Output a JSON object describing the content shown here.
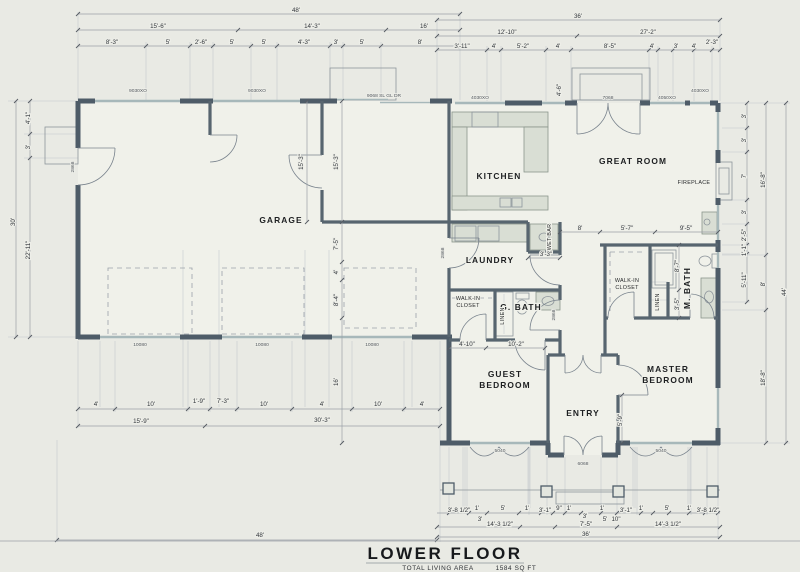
{
  "drawing": {
    "sheet_title": "LOWER FLOOR",
    "area_label": "TOTAL LIVING AREA",
    "area_value": "1584 SQ FT"
  },
  "room_labels": [
    {
      "t": "GARAGE",
      "x": 281,
      "y": 223
    },
    {
      "t": "KITCHEN",
      "x": 499,
      "y": 179
    },
    {
      "t": "GREAT ROOM",
      "x": 633,
      "y": 164
    },
    {
      "t": "LAUNDRY",
      "x": 490,
      "y": 263
    },
    {
      "t": "G. BATH",
      "x": 521,
      "y": 310
    },
    {
      "t": "GUEST",
      "x": 505,
      "y": 377
    },
    {
      "t": "BEDROOM",
      "x": 505,
      "y": 388
    },
    {
      "t": "ENTRY",
      "x": 583,
      "y": 416
    },
    {
      "t": "MASTER",
      "x": 668,
      "y": 372
    },
    {
      "t": "BEDROOM",
      "x": 668,
      "y": 383
    },
    {
      "t": "M. BATH",
      "x": 690,
      "y": 288,
      "r": -90
    }
  ],
  "small_labels": [
    {
      "t": "WET BAR",
      "x": 551,
      "y": 237,
      "r": -90
    },
    {
      "t": "WALK-IN",
      "x": 468,
      "y": 300
    },
    {
      "t": "CLOSET",
      "x": 468,
      "y": 307
    },
    {
      "t": "WALK-IN",
      "x": 627,
      "y": 282
    },
    {
      "t": "CLOSET",
      "x": 627,
      "y": 289
    },
    {
      "t": "LINEN",
      "x": 659,
      "y": 302,
      "r": -90
    },
    {
      "t": "LINEN",
      "x": 504,
      "y": 316,
      "r": -90
    },
    {
      "t": "FIREPLACE",
      "x": 694,
      "y": 184
    }
  ],
  "schedule_labels": [
    {
      "t": "9030XO",
      "x": 138,
      "y": 92
    },
    {
      "t": "9030XO",
      "x": 257,
      "y": 92
    },
    {
      "t": "9068 SL GL DR",
      "x": 384,
      "y": 97
    },
    {
      "t": "4030XO",
      "x": 480,
      "y": 99
    },
    {
      "t": "7068",
      "x": 608,
      "y": 99
    },
    {
      "t": "4050XO",
      "x": 667,
      "y": 99
    },
    {
      "t": "4030XO",
      "x": 700,
      "y": 92
    },
    {
      "t": "10080",
      "x": 140,
      "y": 346
    },
    {
      "t": "10080",
      "x": 262,
      "y": 346
    },
    {
      "t": "10080",
      "x": 372,
      "y": 346
    },
    {
      "t": "5040",
      "x": 500,
      "y": 452
    },
    {
      "t": "6068",
      "x": 583,
      "y": 465
    },
    {
      "t": "5040",
      "x": 661,
      "y": 452
    },
    {
      "t": "2868",
      "x": 74,
      "y": 167,
      "r": -90
    },
    {
      "t": "2868",
      "x": 444,
      "y": 253,
      "r": -90
    },
    {
      "t": "2868",
      "x": 555,
      "y": 315,
      "r": -90
    }
  ],
  "dim_labels": [
    {
      "t": "48'",
      "x": 296,
      "y": 12
    },
    {
      "t": "36'",
      "x": 578,
      "y": 18
    },
    {
      "t": "15'-6\"",
      "x": 158,
      "y": 28
    },
    {
      "t": "14'-3\"",
      "x": 312,
      "y": 28
    },
    {
      "t": "16'",
      "x": 424,
      "y": 28
    },
    {
      "t": "12'-10\"",
      "x": 507,
      "y": 34
    },
    {
      "t": "27'-2\"",
      "x": 648,
      "y": 34
    },
    {
      "t": "8'-3\"",
      "x": 112,
      "y": 44
    },
    {
      "t": "5'",
      "x": 168,
      "y": 44
    },
    {
      "t": "2'-6\"",
      "x": 201,
      "y": 44
    },
    {
      "t": "5'",
      "x": 232,
      "y": 44
    },
    {
      "t": "5'",
      "x": 264,
      "y": 44
    },
    {
      "t": "4'-3\"",
      "x": 304,
      "y": 44
    },
    {
      "t": "3'",
      "x": 336,
      "y": 44
    },
    {
      "t": "5'",
      "x": 362,
      "y": 44
    },
    {
      "t": "8'",
      "x": 420,
      "y": 44
    },
    {
      "t": "3'-11\"",
      "x": 462,
      "y": 48
    },
    {
      "t": "4'",
      "x": 494,
      "y": 48
    },
    {
      "t": "5'-2\"",
      "x": 523,
      "y": 48
    },
    {
      "t": "4'",
      "x": 558,
      "y": 48
    },
    {
      "t": "8'-5\"",
      "x": 610,
      "y": 48
    },
    {
      "t": "4'",
      "x": 652,
      "y": 48
    },
    {
      "t": "3'",
      "x": 676,
      "y": 48
    },
    {
      "t": "4'",
      "x": 694,
      "y": 48
    },
    {
      "t": "2'-3\"",
      "x": 712,
      "y": 44
    },
    {
      "t": "4'-1\"",
      "x": 30,
      "y": 118,
      "r": -90
    },
    {
      "t": "3'",
      "x": 30,
      "y": 147,
      "r": -90
    },
    {
      "t": "30'",
      "x": 15,
      "y": 222,
      "r": -90
    },
    {
      "t": "22'-11\"",
      "x": 30,
      "y": 250,
      "r": -90
    },
    {
      "t": "3'",
      "x": 746,
      "y": 116,
      "r": -90
    },
    {
      "t": "3'",
      "x": 746,
      "y": 140,
      "r": -90
    },
    {
      "t": "7'",
      "x": 746,
      "y": 176,
      "r": -90
    },
    {
      "t": "3'",
      "x": 746,
      "y": 212,
      "r": -90
    },
    {
      "t": "2'-5\"",
      "x": 746,
      "y": 235,
      "r": -90
    },
    {
      "t": "1'-1\"",
      "x": 746,
      "y": 250,
      "r": -90
    },
    {
      "t": "5'-11\"",
      "x": 746,
      "y": 280,
      "r": -90
    },
    {
      "t": "16'-8\"",
      "x": 765,
      "y": 180,
      "r": -90
    },
    {
      "t": "8'",
      "x": 765,
      "y": 284,
      "r": -90
    },
    {
      "t": "18'-8\"",
      "x": 765,
      "y": 378,
      "r": -90
    },
    {
      "t": "44'",
      "x": 786,
      "y": 292,
      "r": -90
    },
    {
      "t": "15'-3\"",
      "x": 303,
      "y": 162,
      "r": -90
    },
    {
      "t": "15'-3\"",
      "x": 338,
      "y": 162,
      "r": -90
    },
    {
      "t": "7'-5\"",
      "x": 338,
      "y": 244,
      "r": -90
    },
    {
      "t": "4'",
      "x": 338,
      "y": 272,
      "r": -90
    },
    {
      "t": "8'-4\"",
      "x": 338,
      "y": 300,
      "r": -90
    },
    {
      "t": "16'",
      "x": 338,
      "y": 382,
      "r": -90
    },
    {
      "t": "4'-6\"",
      "x": 561,
      "y": 90,
      "r": -90
    },
    {
      "t": "8'",
      "x": 580,
      "y": 230
    },
    {
      "t": "5'-7\"",
      "x": 627,
      "y": 230
    },
    {
      "t": "9'-5\"",
      "x": 686,
      "y": 230
    },
    {
      "t": "3'-3\"",
      "x": 546,
      "y": 256
    },
    {
      "t": "4'-10\"",
      "x": 467,
      "y": 346
    },
    {
      "t": "10'-2\"",
      "x": 516,
      "y": 346
    },
    {
      "t": "8'-7\"",
      "x": 679,
      "y": 266,
      "r": -90
    },
    {
      "t": "3'-5\"",
      "x": 679,
      "y": 304,
      "r": -90
    },
    {
      "t": "5'-9\"",
      "x": 622,
      "y": 420,
      "r": -90
    },
    {
      "t": "4'",
      "x": 96,
      "y": 406
    },
    {
      "t": "10'",
      "x": 151,
      "y": 406
    },
    {
      "t": "1'-9\"",
      "x": 199,
      "y": 403
    },
    {
      "t": "7'-3\"",
      "x": 223,
      "y": 403
    },
    {
      "t": "10'",
      "x": 264,
      "y": 406
    },
    {
      "t": "4'",
      "x": 322,
      "y": 406
    },
    {
      "t": "10'",
      "x": 378,
      "y": 406
    },
    {
      "t": "4'",
      "x": 422,
      "y": 406
    },
    {
      "t": "15'-9\"",
      "x": 141,
      "y": 423
    },
    {
      "t": "30'-3\"",
      "x": 322,
      "y": 422
    },
    {
      "t": "48'",
      "x": 260,
      "y": 537
    },
    {
      "t": "3'-8 1/2\"",
      "x": 459,
      "y": 512
    },
    {
      "t": "1'",
      "x": 477,
      "y": 510
    },
    {
      "t": "5'",
      "x": 503,
      "y": 510
    },
    {
      "t": "1'",
      "x": 527,
      "y": 510
    },
    {
      "t": "3'-1\"",
      "x": 545,
      "y": 512
    },
    {
      "t": "9\"",
      "x": 559,
      "y": 510
    },
    {
      "t": "1'",
      "x": 569,
      "y": 510
    },
    {
      "t": "3'",
      "x": 585,
      "y": 518
    },
    {
      "t": "1'",
      "x": 602,
      "y": 510
    },
    {
      "t": "3'-1\"",
      "x": 626,
      "y": 512
    },
    {
      "t": "1'",
      "x": 641,
      "y": 510
    },
    {
      "t": "5'",
      "x": 667,
      "y": 510
    },
    {
      "t": "1'",
      "x": 689,
      "y": 510
    },
    {
      "t": "3'-8 1/2\"",
      "x": 708,
      "y": 512
    },
    {
      "t": "3'",
      "x": 480,
      "y": 521
    },
    {
      "t": "5'",
      "x": 605,
      "y": 521
    },
    {
      "t": "10\"",
      "x": 616,
      "y": 521
    },
    {
      "t": "14'-3 1/2\"",
      "x": 500,
      "y": 526
    },
    {
      "t": "7'-5\"",
      "x": 586,
      "y": 526
    },
    {
      "t": "14'-3 1/2\"",
      "x": 668,
      "y": 526
    },
    {
      "t": "36'",
      "x": 586,
      "y": 536
    }
  ]
}
